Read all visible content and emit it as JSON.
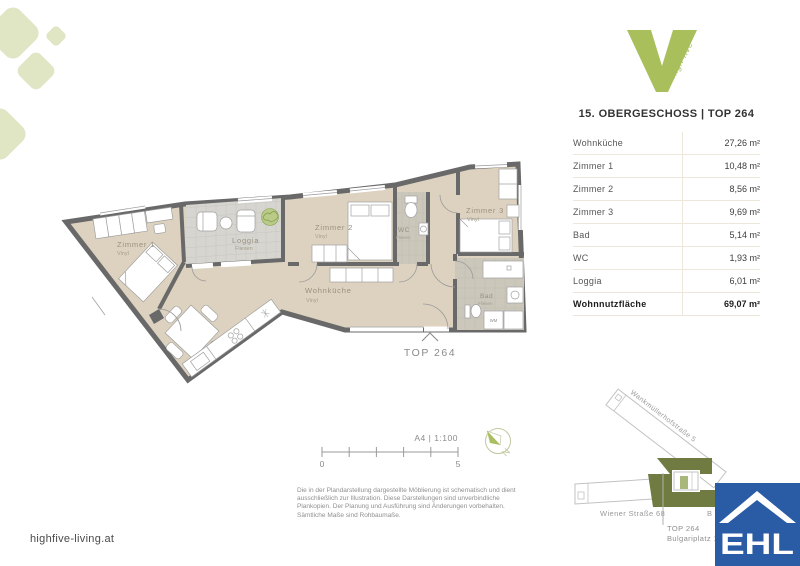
{
  "colors": {
    "brand_green": "#a8bf5c",
    "diamond_green": "#e0e5c4",
    "floor_beige": "#ddd2bf",
    "tile_gray": "#cbc7bb",
    "loggia_gray": "#d6d5d0",
    "wall_gray": "#696969",
    "map_olive": "#6f7b41",
    "ehl_blue": "#2a5ba5"
  },
  "brand": {
    "logo_text": "high five"
  },
  "header": {
    "title": "15. OBERGESCHOSS | TOP 264"
  },
  "area_table": {
    "rows": [
      {
        "label": "Wohnküche",
        "value": "27,26 m²"
      },
      {
        "label": "Zimmer 1",
        "value": "10,48 m²"
      },
      {
        "label": "Zimmer 2",
        "value": "8,56 m²"
      },
      {
        "label": "Zimmer 3",
        "value": "9,69 m²"
      },
      {
        "label": "Bad",
        "value": "5,14 m²"
      },
      {
        "label": "WC",
        "value": "1,93 m²"
      },
      {
        "label": "Loggia",
        "value": "6,01 m²"
      }
    ],
    "total": {
      "label": "Wohnnutzfläche",
      "value": "69,07 m²"
    }
  },
  "floor_plan": {
    "rooms": [
      {
        "name": "Zimmer 1",
        "floor": "Vinyl"
      },
      {
        "name": "Loggia",
        "floor": "Fliesen"
      },
      {
        "name": "Zimmer 2",
        "floor": "Vinyl"
      },
      {
        "name": "WC",
        "floor": "Fliesen"
      },
      {
        "name": "Zimmer 3",
        "floor": "Vinyl"
      },
      {
        "name": "Wohnküche",
        "floor": "Vinyl"
      },
      {
        "name": "Bad",
        "floor": "Fliesen"
      }
    ],
    "appliance": "WM",
    "unit_marker": "TOP 264"
  },
  "scale_bar": {
    "sheet": "A4 | 1:100",
    "min": "0",
    "max": "5"
  },
  "compass": {
    "north": "N"
  },
  "disclaimer": {
    "lines": [
      "Die in der Plandarstellung dargestellte Möblierung ist schematisch und dient",
      "ausschließlich zur Illustration. Diese Darstellungen sind unverbindliche",
      "Plankopien. Der Planung und Ausführung sind Änderungen vorbehalten.",
      "Sämtliche Maße sind Rohbaumaße."
    ]
  },
  "footer": {
    "website": "highfive-living.at"
  },
  "map": {
    "street_diagonal": "Wankmüllerhofstraße 5",
    "street_horizontal": "Wiener Straße 68",
    "partial_label": "B",
    "marker_line1": "TOP 264",
    "marker_line2": "Bulgariplatz 11"
  },
  "ehl_logo": {
    "text": "EHL"
  }
}
